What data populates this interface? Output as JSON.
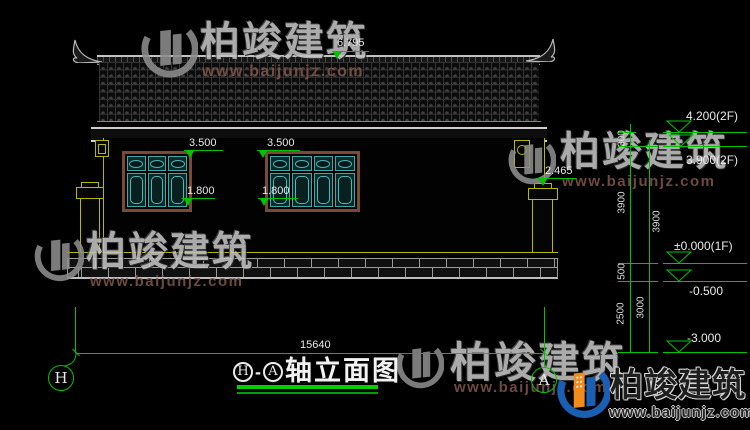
{
  "brand": {
    "name": "柏竣建筑",
    "url": "www.baijunjz.com"
  },
  "title": {
    "axis_left": "H",
    "separator": "-",
    "axis_right": "A",
    "text": "轴立面图"
  },
  "axis_bubbles": {
    "left": "H",
    "right": "A"
  },
  "dimensions": {
    "ridge_height": "6.795",
    "window_top": [
      "3.500",
      "3.500"
    ],
    "window_sill": [
      "1.800",
      "1.800"
    ],
    "side_wall": "2.465",
    "total_width": "15640",
    "chain_inner": [
      "300",
      "3900",
      "500",
      "2500"
    ],
    "chain_outer": [
      "3900",
      "3000"
    ],
    "levels": [
      "4.200(2F)",
      "3.900(2F)",
      "±0.000(1F)",
      "-0.500",
      "-3.000"
    ]
  },
  "windows": [
    {
      "panes": 3
    },
    {
      "panes": 4
    }
  ],
  "colors": {
    "dimension_green": "#00c400",
    "cad_yellow": "#b8b800",
    "window_teal": "#3fa8a8",
    "frame_brown": "#7a4a35",
    "logo_blue": "#1a5fb4",
    "logo_orange": "#f28a1e"
  }
}
